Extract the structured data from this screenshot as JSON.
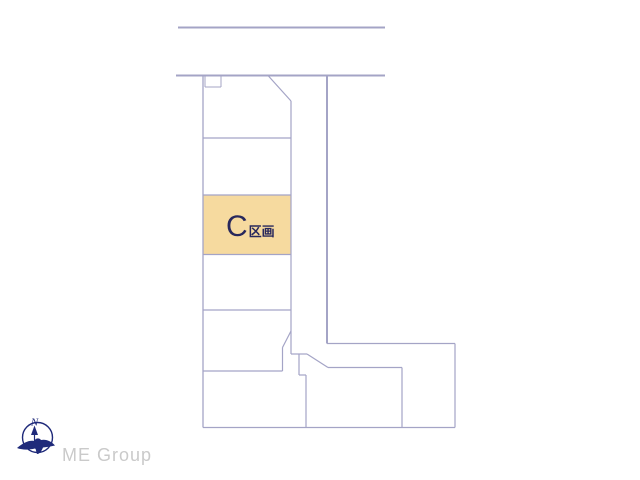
{
  "diagram": {
    "background": "#ffffff",
    "line_color": "#a4a4c6",
    "highlight": {
      "x": 203.5,
      "y": 195.5,
      "width": 87,
      "height": 58.5,
      "fill": "#f6da9f"
    },
    "label": {
      "main": "C",
      "sub": "区画",
      "color": "#28285c"
    },
    "segments": [
      [
        178,
        27.5,
        385,
        27.5,
        2
      ],
      [
        176,
        75.5,
        385,
        75.5,
        2
      ],
      [
        203,
        75.5,
        203,
        427.5,
        1.3
      ],
      [
        203,
        427.5,
        455,
        427.5,
        1.2
      ],
      [
        205,
        75.5,
        205,
        87,
        1
      ],
      [
        205,
        87,
        221,
        87,
        1
      ],
      [
        221,
        87,
        221,
        75.5,
        1
      ],
      [
        203,
        138,
        291,
        138,
        1.2
      ],
      [
        203,
        195,
        291,
        195,
        1.2
      ],
      [
        203,
        254.5,
        291,
        254.5,
        1.2
      ],
      [
        203,
        310,
        291,
        310,
        1.2
      ],
      [
        203,
        371,
        282.5,
        371,
        1.2
      ],
      [
        268,
        75.5,
        291,
        101,
        1.2
      ],
      [
        291,
        101,
        291,
        354,
        1.2
      ],
      [
        291,
        331,
        282.5,
        347.5,
        1.2
      ],
      [
        282.5,
        347.5,
        282.5,
        371,
        1.2
      ],
      [
        327,
        75.5,
        327,
        343.5,
        2
      ],
      [
        327,
        343.5,
        455,
        343.5,
        1.3
      ],
      [
        455,
        343.5,
        455,
        427.5,
        1.2
      ],
      [
        291,
        354,
        307,
        354,
        1.2
      ],
      [
        307,
        354,
        328,
        367.5,
        1.2
      ],
      [
        328,
        367.5,
        402,
        367.5,
        1.2
      ],
      [
        402,
        367.5,
        402,
        427.5,
        1.2
      ],
      [
        299,
        354,
        299,
        375,
        1.2
      ],
      [
        299,
        375,
        306,
        375,
        1.2
      ],
      [
        306,
        375,
        306,
        427.5,
        1.2
      ]
    ]
  },
  "logo": {
    "company": "ME Group",
    "text_color": "#cacaca",
    "color": "#1f2a7a",
    "compass_letter": "N"
  }
}
